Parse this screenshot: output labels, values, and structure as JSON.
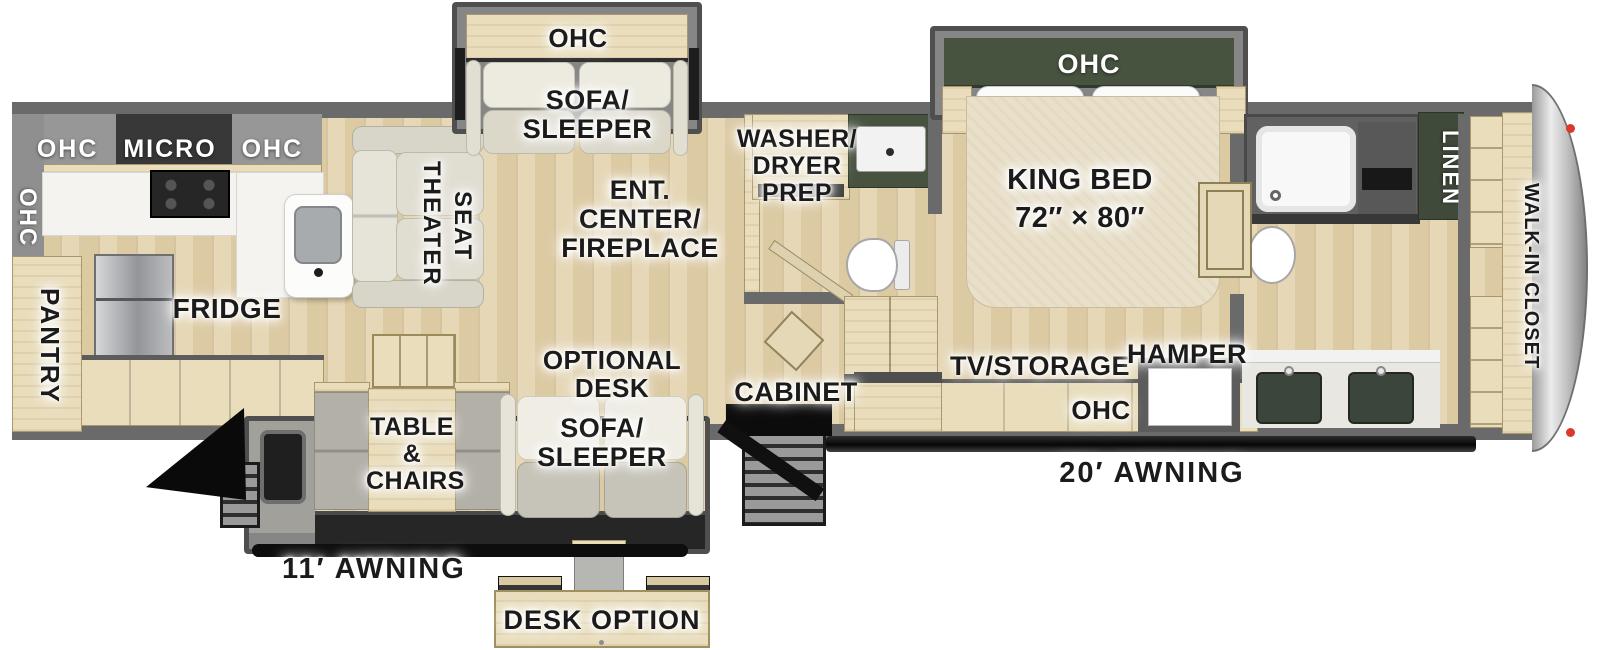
{
  "diagram_type": "rv-fifth-wheel-floorplan",
  "colors": {
    "floor_wood": "#e2d2ac",
    "cabinet_wood": "#e9ddbc",
    "wall_gray": "#6a6a6a",
    "slide_gray": "#868686",
    "accent_dark_green": "#47523f",
    "fabric_light": "#e9e6db",
    "steel": "#9b9da0",
    "black": "#111111",
    "marker_red": "#d93a2b"
  },
  "labels": {
    "ohc_left_wall": "OHC",
    "ohc_micro_ohc": "OHC MICRO OHC",
    "pantry": "PANTRY",
    "fridge": "FRIDGE",
    "theater_line1": "THEATER",
    "theater_line2": "SEAT",
    "ohc_sofa_slide": "OHC",
    "sofa_top_line1": "SOFA/",
    "sofa_top_line2": "SLEEPER",
    "ent_line1": "ENT.",
    "ent_line2": "CENTER/",
    "ent_line3": "FIREPLACE",
    "wd_line1": "WASHER/",
    "wd_line2": "DRYER",
    "wd_line3": "PREP",
    "ohc_bed_slide": "OHC",
    "king_bed_line1": "KING BED",
    "king_bed_line2": "72″ × 80″",
    "linen": "LINEN",
    "walk_in_closet": "WALK-IN CLOSET",
    "table_line1": "TABLE",
    "table_line2": "&",
    "table_line3": "CHAIRS",
    "optional_line1": "OPTIONAL",
    "optional_line2": "DESK",
    "sofa_bottom_line1": "SOFA/",
    "sofa_bottom_line2": "SLEEPER",
    "cabinet": "CABINET",
    "tv_storage": "TV/STORAGE",
    "hamper": "HAMPER",
    "ohc_bottom": "OHC",
    "awning_20": "20′ AWNING",
    "awning_11": "11′ AWNING",
    "desk_option": "DESK OPTION"
  }
}
